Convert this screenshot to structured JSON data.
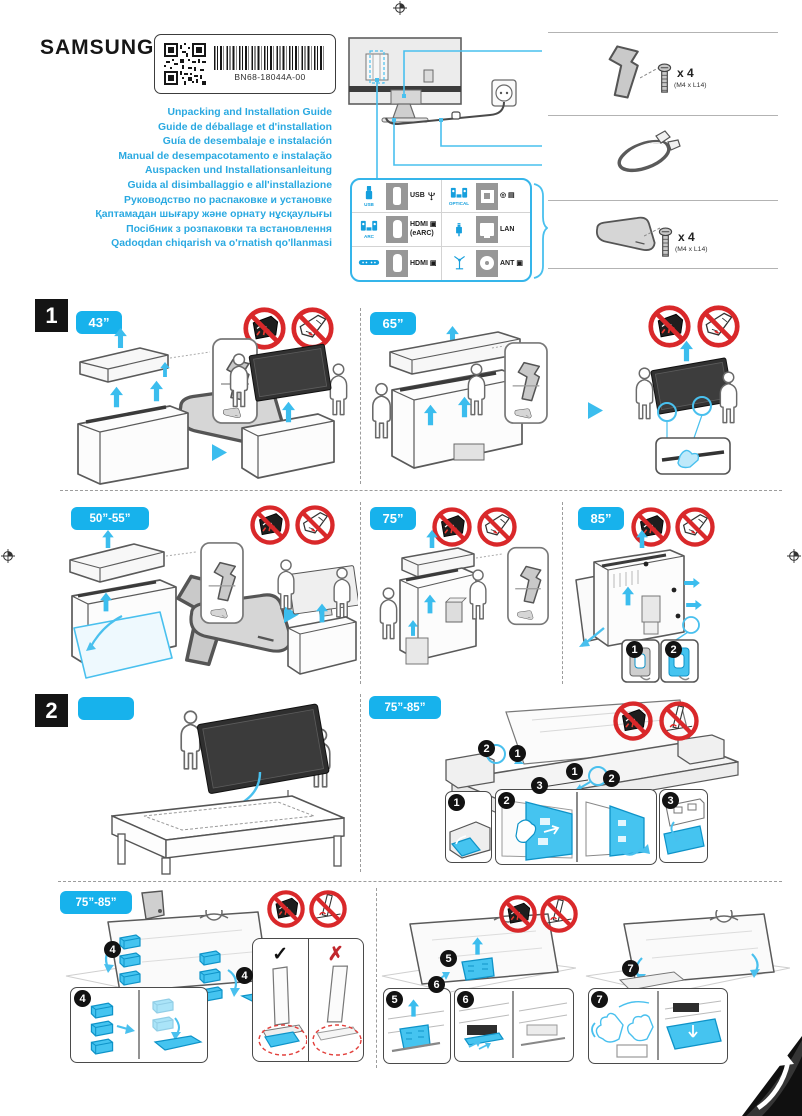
{
  "header": {
    "brand": "SAMSUNG",
    "part_number": "BN68-18044A-00",
    "titles": [
      "Unpacking and Installation Guide",
      "Guide de déballage et d'installation",
      "Guía de desembalaje e instalación",
      "Manual de desempacotamento e instalação",
      "Auspacken und Installationsanleitung",
      "Guida al disimballaggio e all'installazione",
      "Руководство по распаковке и установке",
      "Қаптамадан шығару және орнату нұсқаулығы",
      "Посібник з розпаковки та встановлення",
      "Qadoqdan chiqarish va o'rnatish qo'llanmasi"
    ]
  },
  "ports": {
    "left": [
      {
        "caption": "USB",
        "label": "USB"
      },
      {
        "caption": "ARC",
        "label": "HDMI ▣",
        "label2": "(eARC)"
      },
      {
        "caption": "",
        "label": "HDMI ▣"
      }
    ],
    "right": [
      {
        "caption": "OPTICAL",
        "label": "◎ ▤"
      },
      {
        "caption": "",
        "label": "LAN"
      },
      {
        "caption": "",
        "label": "ANT ▣"
      }
    ]
  },
  "accessories": {
    "screw_qty": "x 4",
    "screw_spec": "(M4 x L14)"
  },
  "sections": {
    "one": "1",
    "two": "2"
  },
  "sizes": {
    "s43": "43”",
    "s65": "65”",
    "s50_55": "50”-55”",
    "s75": "75”",
    "s85": "85”",
    "s75_85": "75”-85”",
    "blank": ""
  },
  "steps": {
    "n1": "1",
    "n2": "2",
    "n3": "3",
    "n4": "4",
    "n5": "5",
    "n6": "6",
    "n7": "7"
  },
  "marks": {
    "check": "✓",
    "cross": "✗"
  }
}
